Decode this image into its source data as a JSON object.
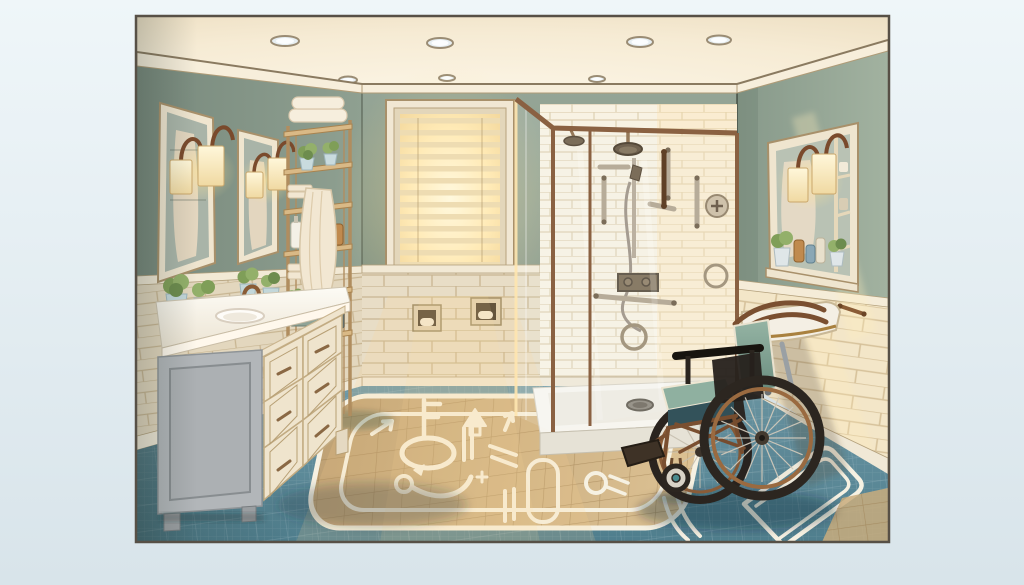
{
  "scene": {
    "title": "Wheelchair-accessible bathroom illustration",
    "alt": "Digital illustration of a wheelchair-accessible bathroom: a cream vanity with white counter and potted plants, two framed mirrors with bronze sconce lamps, a wooden ladder shelf stacked with towels, a sunlit window with venetian blinds, a glass walk-in shower with grab bars and handheld sprayer, a wall-mounted fold-down seat, an empty manual wheelchair with teal cushions, and white accessibility clearance markings painted on the teal tile floor.",
    "style": "warm architectural illustration",
    "elements": {
      "ceiling": "ceiling with seven recessed lights",
      "window": "window glowing with sunlight through blinds",
      "vanity": "cream vanity, white counter, oval sink, bronze faucet, plants",
      "mirrors": "two framed wall mirrors with double sconce lamps",
      "shelf": "wooden ladder shelf with towels, plants, bottles and hanging towel",
      "niches": "two recessed dispenser niches under the window",
      "shower": "glass roll-in shower with rain head, slide-bar sprayer, grab bars, control niche and low threshold tray",
      "right_cabinet": "mirrored shelf cabinet with sconces and toiletries",
      "fold_down_seat": "wall-mounted fold-down transfer seat",
      "wheelchair": "manual wheelchair with copper hand rims and teal cushions",
      "floor": "teal mosaic floor with tan turning zone and white guidance markings"
    },
    "palette": {
      "background": "#e7f0f5",
      "frame": "#575046",
      "wall_green": "#8c9d8f",
      "ceiling": "#f8eedb",
      "wainscot_tile": "#e8ddc6",
      "shower_tile": "#f8f2e3",
      "sunlit_tile": "#f3e6c8",
      "floor_teal": "#5d8a9c",
      "floor_tan": "#c9ad7e",
      "marking_white": "#f6f1e2",
      "bronze": "#8a5c36",
      "counter_white": "#fbf8f1",
      "cabinet_gray": "#b2b6b9",
      "cushion_teal": "#7da294",
      "lamp_glow": "#ffe9b8"
    }
  }
}
